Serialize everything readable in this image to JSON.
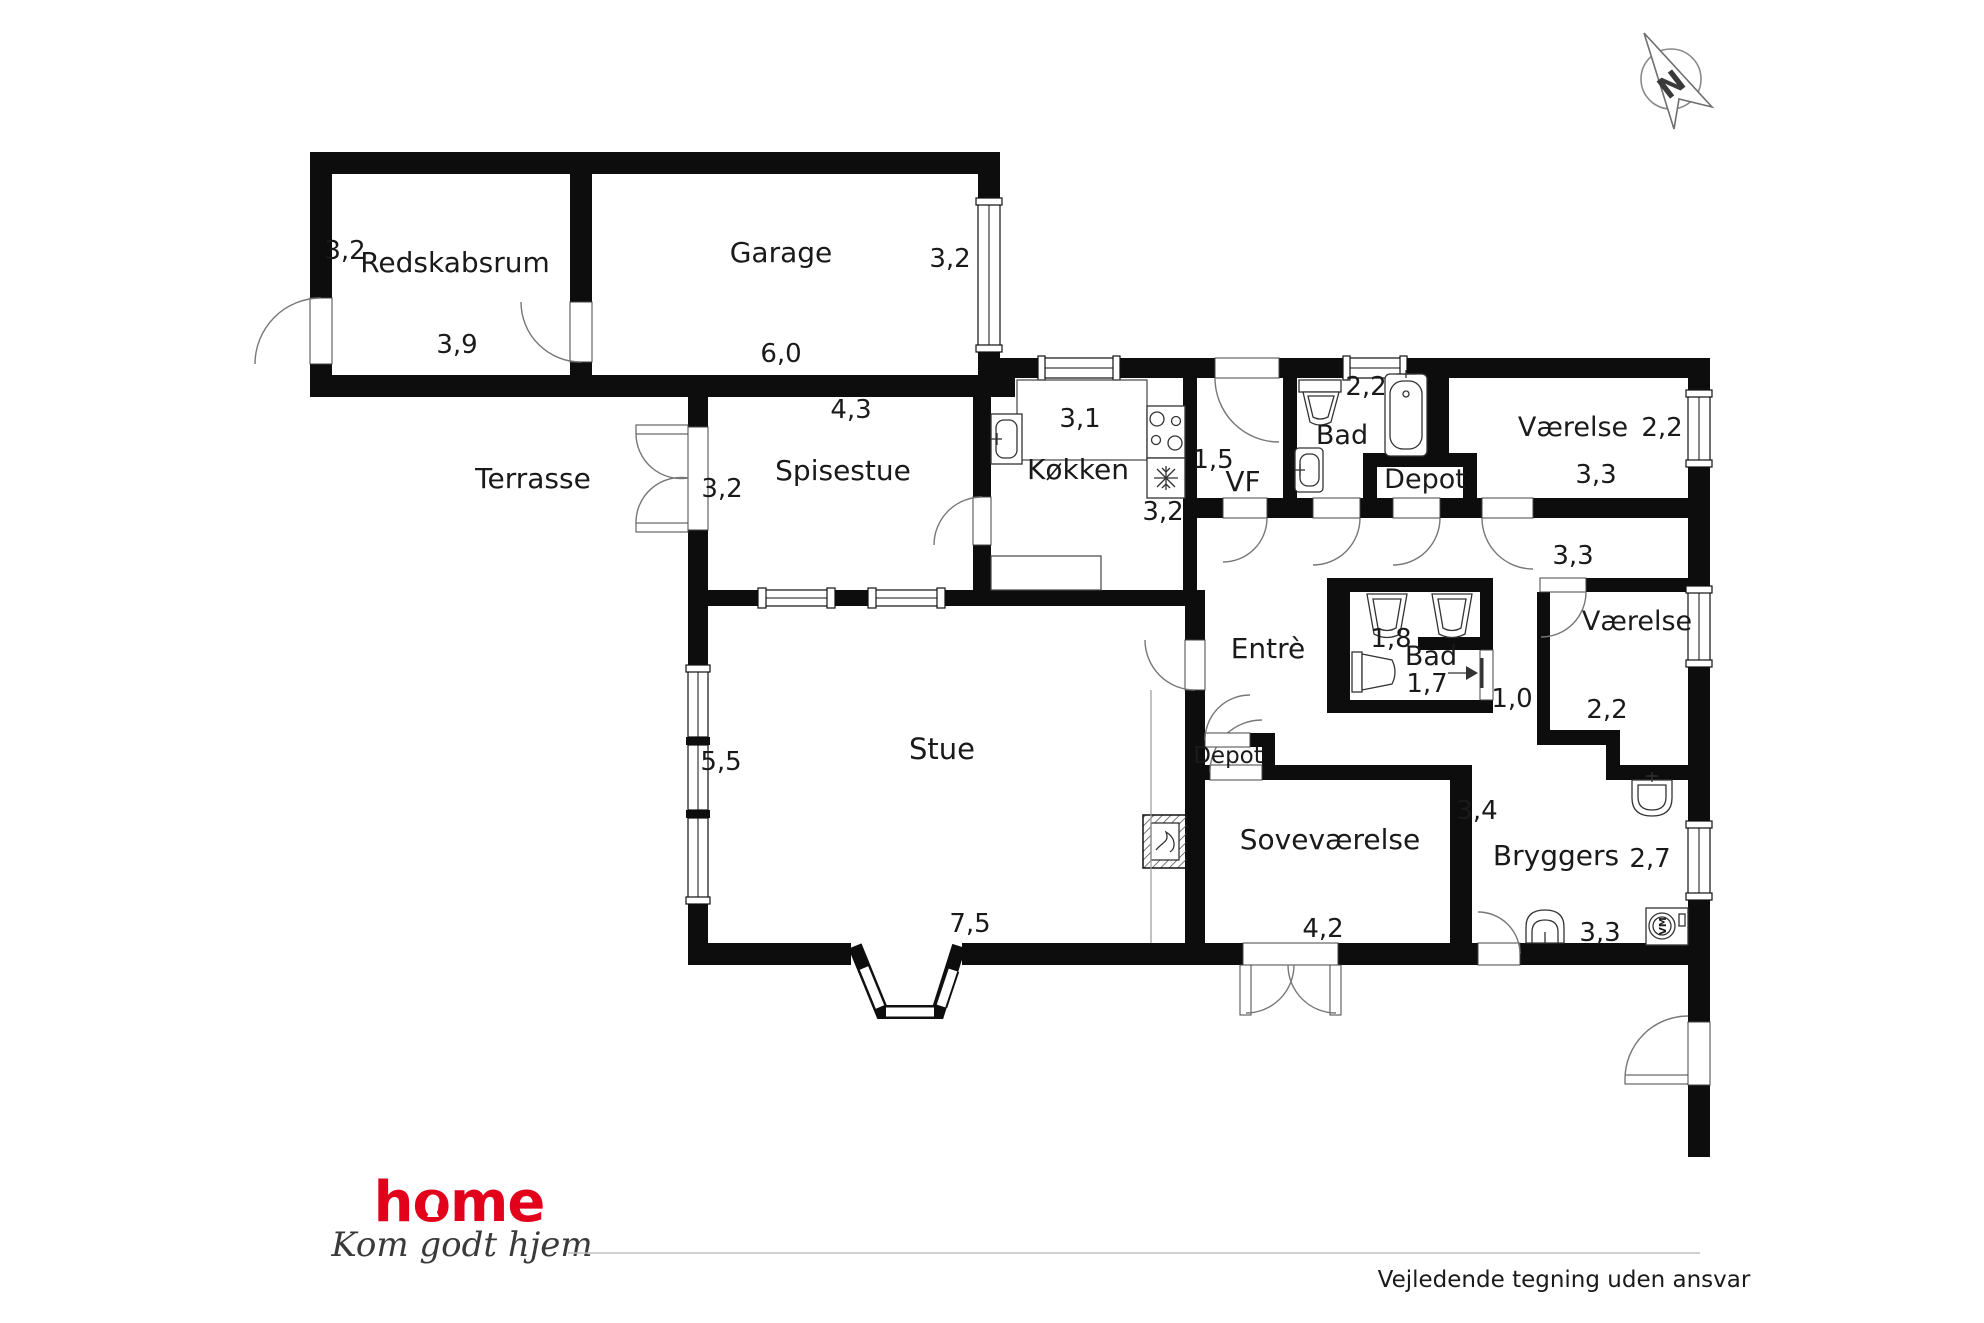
{
  "plan": {
    "rooms": [
      {
        "id": "redskabsrum",
        "label": "Redskabsrum",
        "x": 455,
        "y": 272,
        "fs": 28
      },
      {
        "id": "garage",
        "label": "Garage",
        "x": 781,
        "y": 262,
        "fs": 28
      },
      {
        "id": "terrasse",
        "label": "Terrasse",
        "x": 533,
        "y": 488,
        "fs": 28
      },
      {
        "id": "spisestue",
        "label": "Spisestue",
        "x": 843,
        "y": 480,
        "fs": 28
      },
      {
        "id": "kokken",
        "label": "Køkken",
        "x": 1078,
        "y": 479,
        "fs": 28
      },
      {
        "id": "vf",
        "label": "VF",
        "x": 1243,
        "y": 491,
        "fs": 28
      },
      {
        "id": "bad-top",
        "label": "Bad",
        "x": 1342,
        "y": 444,
        "fs": 27
      },
      {
        "id": "depot-top",
        "label": "Depot",
        "x": 1425,
        "y": 488,
        "fs": 27
      },
      {
        "id": "vaerelse-top-right",
        "label": "Værelse",
        "x": 1573,
        "y": 436,
        "fs": 27
      },
      {
        "id": "vaerelse-right",
        "label": "Værelse",
        "x": 1637,
        "y": 630,
        "fs": 27
      },
      {
        "id": "entre",
        "label": "Entrè",
        "x": 1268,
        "y": 658,
        "fs": 28
      },
      {
        "id": "bad-mid",
        "label": "Bad",
        "x": 1431,
        "y": 665,
        "fs": 27
      },
      {
        "id": "stue",
        "label": "Stue",
        "x": 942,
        "y": 759,
        "fs": 29
      },
      {
        "id": "depot-mid",
        "label": "Depot",
        "x": 1228,
        "y": 763,
        "fs": 23
      },
      {
        "id": "sovevaerelse",
        "label": "Soveværelse",
        "x": 1330,
        "y": 849,
        "fs": 28
      },
      {
        "id": "bryggers",
        "label": "Bryggers",
        "x": 1556,
        "y": 865,
        "fs": 28
      }
    ],
    "dims": [
      {
        "id": "redskabsrum-h",
        "label": "3,2",
        "x": 345,
        "y": 259
      },
      {
        "id": "redskabsrum-w",
        "label": "3,9",
        "x": 457,
        "y": 353
      },
      {
        "id": "garage-h",
        "label": "3,2",
        "x": 950,
        "y": 267
      },
      {
        "id": "garage-w",
        "label": "6,0",
        "x": 781,
        "y": 362
      },
      {
        "id": "spisestue-w",
        "label": "4,3",
        "x": 851,
        "y": 418
      },
      {
        "id": "spisestue-h",
        "label": "3,2",
        "x": 722,
        "y": 497
      },
      {
        "id": "kokken-w",
        "label": "3,1",
        "x": 1080,
        "y": 427
      },
      {
        "id": "kokken-h",
        "label": "3,2",
        "x": 1163,
        "y": 520
      },
      {
        "id": "vf-w",
        "label": "1,5",
        "x": 1213,
        "y": 468
      },
      {
        "id": "bad-top-w",
        "label": "2,2",
        "x": 1366,
        "y": 395
      },
      {
        "id": "vaerelse-tr-w",
        "label": "3,3",
        "x": 1596,
        "y": 483
      },
      {
        "id": "vaerelse-tr-h",
        "label": "2,2",
        "x": 1662,
        "y": 436
      },
      {
        "id": "gang-w",
        "label": "3,3",
        "x": 1573,
        "y": 564
      },
      {
        "id": "vaerelse-r-w",
        "label": "2,2",
        "x": 1607,
        "y": 718
      },
      {
        "id": "bad-mid-w",
        "label": "1,8",
        "x": 1391,
        "y": 647
      },
      {
        "id": "bad-mid-h",
        "label": "1,7",
        "x": 1427,
        "y": 692
      },
      {
        "id": "gang2-w",
        "label": "1,0",
        "x": 1512,
        "y": 707
      },
      {
        "id": "stue-h",
        "label": "5,5",
        "x": 721,
        "y": 770
      },
      {
        "id": "stue-w",
        "label": "7,5",
        "x": 970,
        "y": 932
      },
      {
        "id": "sovevaerelse-w",
        "label": "4,2",
        "x": 1323,
        "y": 937
      },
      {
        "id": "sovevaerelse-h",
        "label": "3,4",
        "x": 1477,
        "y": 819
      },
      {
        "id": "bryggers-h",
        "label": "2,7",
        "x": 1650,
        "y": 867
      },
      {
        "id": "bryggers-w",
        "label": "3,3",
        "x": 1600,
        "y": 941
      }
    ]
  },
  "fixtures": {
    "washing_machine": "VM"
  },
  "compass": {
    "label": "N"
  },
  "logo": {
    "brand": "home",
    "tagline": "Kom godt hjem",
    "brand_color": "#e2001a"
  },
  "footer": {
    "disclaimer": "Vejledende tegning uden ansvar"
  }
}
